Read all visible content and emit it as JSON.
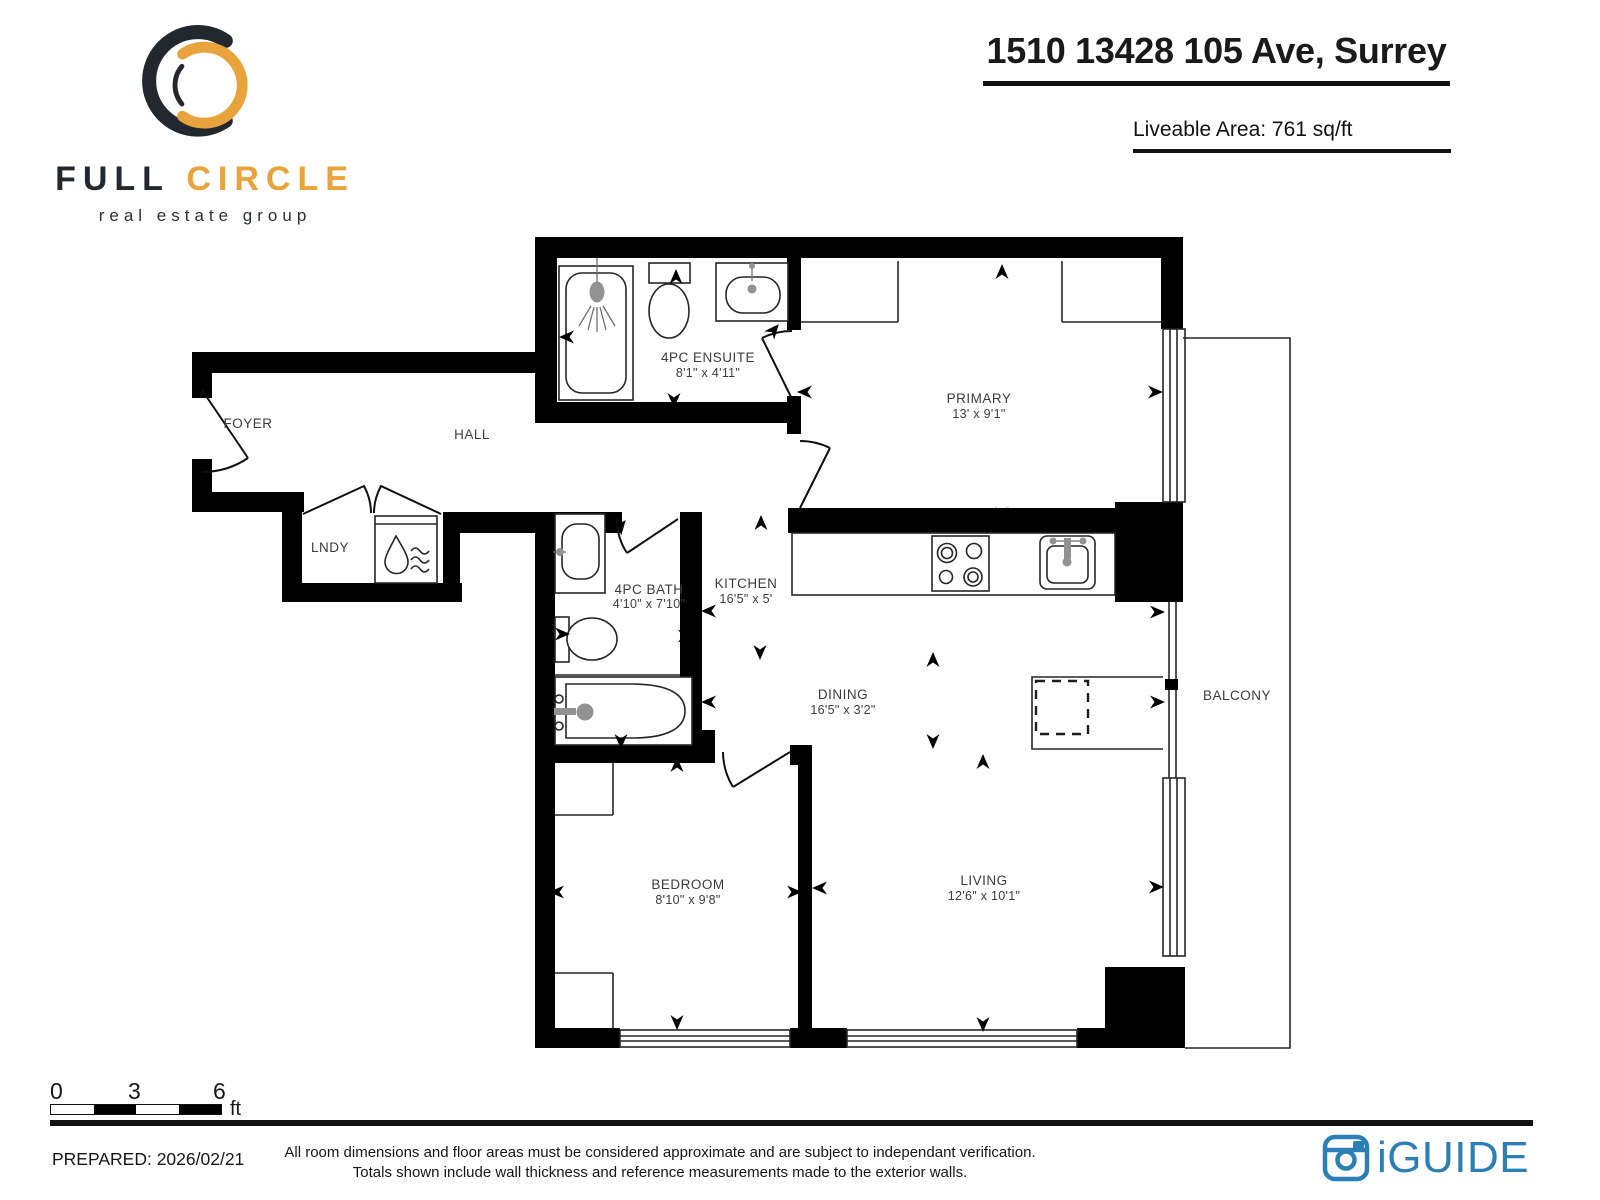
{
  "logo": {
    "word1": "FULL",
    "word2": "CIRCLE",
    "tagline": "real estate group"
  },
  "header": {
    "title": "1510 13428 105 Ave, Surrey",
    "liveable_area": "Liveable Area: 761 sq/ft"
  },
  "rooms": {
    "foyer": {
      "name": "FOYER"
    },
    "hall": {
      "name": "HALL"
    },
    "lndy": {
      "name": "LNDY"
    },
    "ensuite": {
      "name": "4PC ENSUITE",
      "dims": "8'1\" x 4'11\""
    },
    "bath": {
      "name": "4PC BATH",
      "dims": "4'10\" x 7'10\""
    },
    "kitchen": {
      "name": "KITCHEN",
      "dims": "16'5\" x 5'"
    },
    "dining": {
      "name": "DINING",
      "dims": "16'5\" x 3'2\""
    },
    "primary": {
      "name": "PRIMARY",
      "dims": "13' x 9'1\""
    },
    "bedroom": {
      "name": "BEDROOM",
      "dims": "8'10\" x 9'8\""
    },
    "living": {
      "name": "LIVING",
      "dims": "12'6\" x 10'1\""
    },
    "balcony": {
      "name": "BALCONY"
    }
  },
  "scale_bar": {
    "tick0": "0",
    "tick1": "3",
    "tick2": "6",
    "unit": "ft"
  },
  "footer": {
    "prepared": "PREPARED: 2026/02/21",
    "disclaimer1": "All room dimensions and floor areas must be considered approximate and are subject to independant verification.",
    "disclaimer2": "Totals shown include wall thickness and reference measurements made to the exterior walls.",
    "brand": "iGUIDE"
  },
  "colors": {
    "wall_black": "#000000",
    "label_gray": "#3C3C3C",
    "logo_dark": "#23282F",
    "accent_orange": "#E9A33C",
    "brand_blue": "#2B7FB5"
  }
}
